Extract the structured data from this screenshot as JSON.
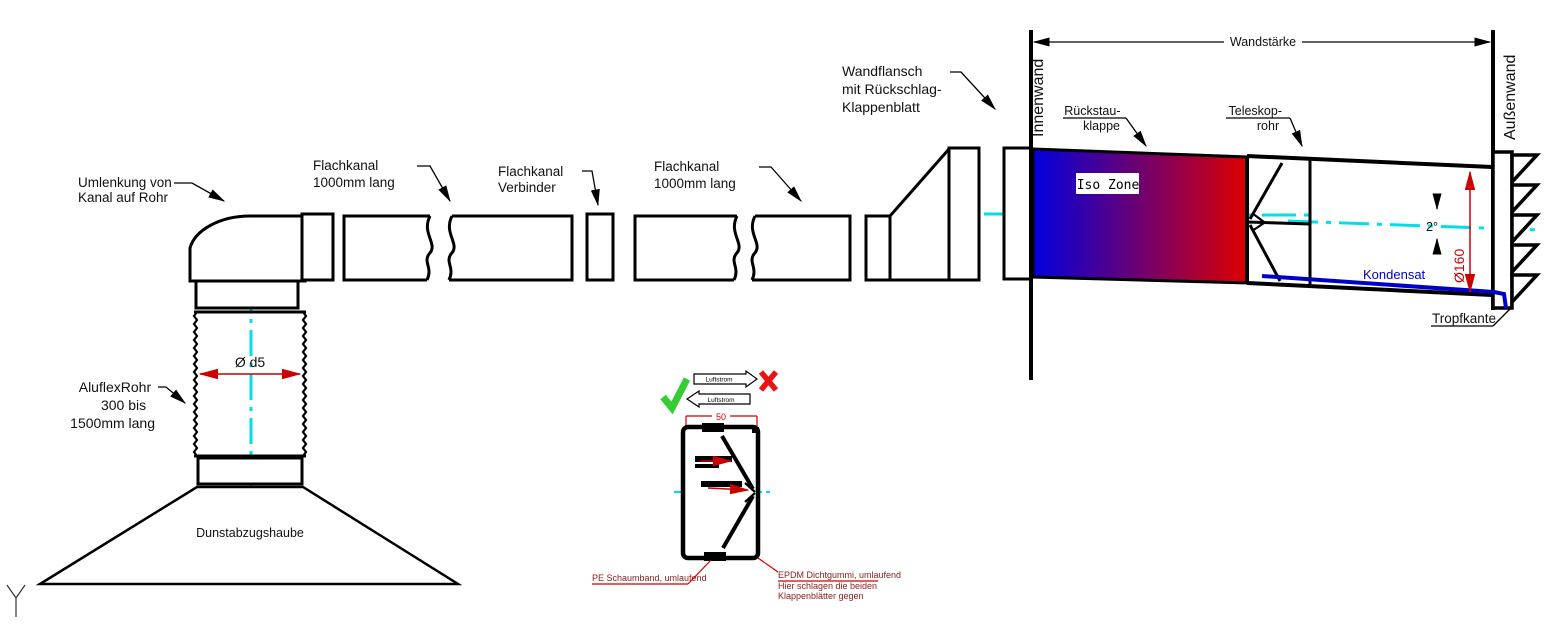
{
  "labels": {
    "umlenkung_1": "Umlenkung von",
    "umlenkung_2": "Kanal auf Rohr",
    "flachkanal_1a": "Flachkanal",
    "flachkanal_1b": "1000mm lang",
    "verbinder_a": "Flachkanal",
    "verbinder_b": "Verbinder",
    "flachkanal_2a": "Flachkanal",
    "flachkanal_2b": "1000mm lang",
    "wandflansch_1": "Wandflansch",
    "wandflansch_2": "mit Rückschlag-",
    "wandflansch_3": "Klappenblatt",
    "aluflex_1": "AluflexRohr",
    "aluflex_2": "300 bis",
    "aluflex_3": "1500mm lang",
    "dim_d5": "Ø d5",
    "dunstabzugshaube": "Dunstabzugshaube",
    "innenwand": "Innenwand",
    "aussenwand": "Außenwand",
    "wandstaerke": "Wandstärke",
    "rueckstau_1": "Rückstau-",
    "rueckstau_2": "klappe",
    "teleskop_1": "Teleskop-",
    "teleskop_2": "rohr",
    "iso_zone": "Iso Zone",
    "kondensat": "Kondensat",
    "dim_160": "Ø160",
    "winkel_2grad": "2°",
    "tropfkante": "Tropfkante"
  },
  "detail": {
    "luftstrom_right": "Luftstrom",
    "luftstrom_left": "Luftstrom",
    "dim_50": "50",
    "pe_schaumband": "PE Schaumband, umlaufend",
    "epdm_1": "EPDM Dichtgummi, umlaufend",
    "epdm_2": "Hier schlagen die beiden",
    "epdm_3": "Klappenblätter gegen"
  },
  "colors": {
    "centerline": "#00dfe8",
    "kondensat_blue": "#0000cc",
    "dimension_red": "#cc0000",
    "check_green": "#35cc35",
    "cross_red": "#ee1111",
    "iso_gradient_start": "#0000dd",
    "iso_gradient_end": "#dd0000",
    "detail_text": "#8b2020"
  }
}
